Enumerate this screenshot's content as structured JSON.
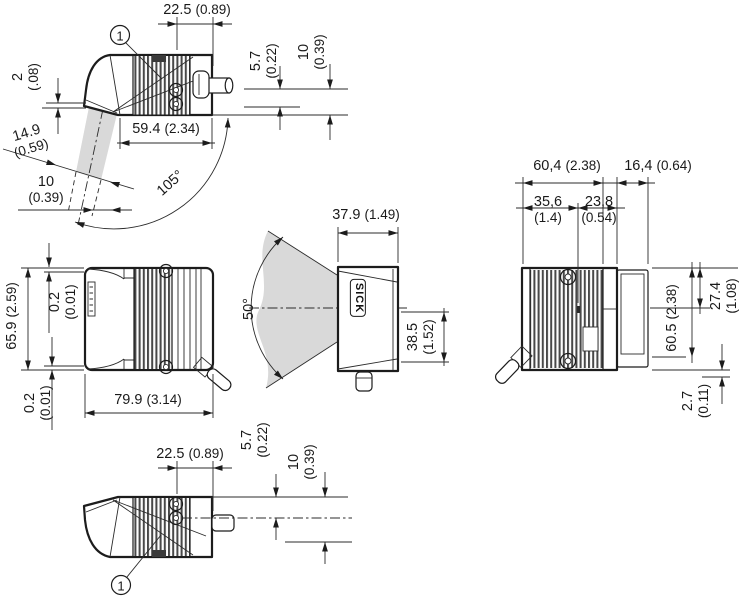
{
  "brand": {
    "logo": "SICK"
  },
  "callouts": {
    "marker": "1"
  },
  "colors": {
    "line": "#1c1c1c",
    "beam_fill": "#d9d9d9",
    "housing_fill": "#ffffff",
    "fin_dark": "#484848"
  },
  "views": {
    "side": {
      "dims": {
        "w22_5": {
          "mm": "22.5",
          "inch": "(0.89)"
        },
        "e2": {
          "mm": "2",
          "inch": "(.08)"
        },
        "a5_7": {
          "mm": "5.7",
          "inch": "(0.22)"
        },
        "a10": {
          "mm": "10",
          "inch": "(0.39)"
        },
        "l59_4": {
          "mm": "59.4",
          "inch": "(2.34)"
        },
        "win14_9": {
          "mm": "14.9",
          "inch": "(0.59)"
        },
        "win10": {
          "mm": "10",
          "inch": "(0.39)"
        },
        "ang105": {
          "deg": "105°"
        }
      }
    },
    "top": {
      "dims": {
        "w65_9": {
          "mm": "65.9",
          "inch": "(2.59)"
        },
        "g0_2a": {
          "mm": "0.2",
          "inch": "(0.01)"
        },
        "g0_2b": {
          "mm": "0.2",
          "inch": "(0.01)"
        },
        "l79_9": {
          "mm": "79.9",
          "inch": "(3.14)"
        }
      }
    },
    "front": {
      "dims": {
        "w37_9": {
          "mm": "37.9",
          "inch": "(1.49)"
        },
        "h38_5": {
          "mm": "38.5",
          "inch": "(1.52)"
        },
        "ang50": {
          "deg": "50°"
        }
      }
    },
    "rear": {
      "dims": {
        "w60_4": {
          "mm": "60,4",
          "inch": "(2.38)"
        },
        "w16_4": {
          "mm": "16,4",
          "inch": "(0.64)"
        },
        "w35_6": {
          "mm": "35,6",
          "inch": "(1.4)"
        },
        "w23_8": {
          "mm": "23,8",
          "inch": "(0.54)"
        },
        "h27_4": {
          "mm": "27.4",
          "inch": "(1.08)"
        },
        "h60_5": {
          "mm": "60.5",
          "inch": "(2.38)"
        },
        "c2_7": {
          "mm": "2.7",
          "inch": "(0.11)"
        }
      }
    },
    "bottom": {
      "dims": {
        "w22_5": {
          "mm": "22.5",
          "inch": "(0.89)"
        },
        "a5_7": {
          "mm": "5.7",
          "inch": "(0.22)"
        },
        "a10": {
          "mm": "10",
          "inch": "(0.39)"
        }
      }
    }
  }
}
